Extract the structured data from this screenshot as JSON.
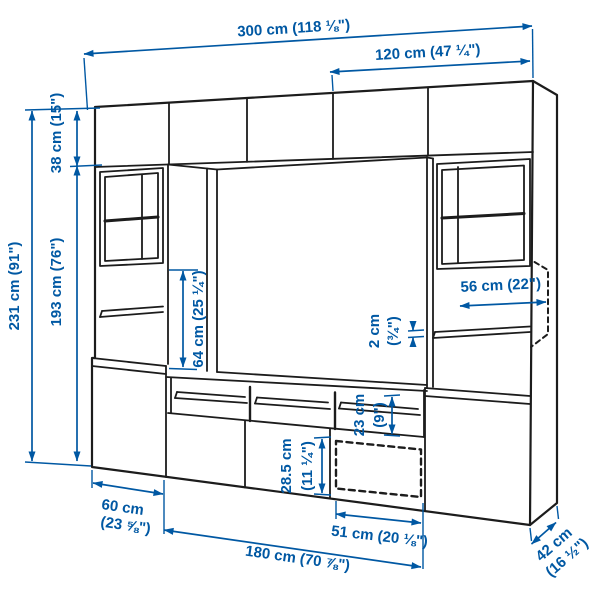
{
  "diagram": {
    "title": "tv-storage-combination-dimension-diagram",
    "accent_color": "#0058a3",
    "line_color": "#1c1c1c",
    "background_color": "#ffffff",
    "dimensions": {
      "total_width": "300 cm (118 ⅛\")",
      "right_section_width": "120 cm (47 ¼\")",
      "total_height": "231 cm (91\")",
      "top_cabinet_height": "38 cm (15\")",
      "lower_section_height": "193 cm (76\")",
      "tv_space_height": "64 cm (25 ¼\")",
      "shelf_thickness_cm": "2 cm",
      "shelf_thickness_in": "(¾\")",
      "shelf_depth": "56 cm (22\")",
      "compartment_height_cm": "23 cm",
      "compartment_height_in": "(9\")",
      "drawer_height_cm": "28.5 cm",
      "drawer_height_in": "(11 ¼\")",
      "side_cabinet_width_cm": "60 cm",
      "side_cabinet_width_in": "(23 ⅝\")",
      "drawer_width": "51 cm (20 ⅛\")",
      "bench_width": "180 cm (70 ⅞\")",
      "depth_cm": "42 cm",
      "depth_in": "(16 ½\")"
    }
  }
}
